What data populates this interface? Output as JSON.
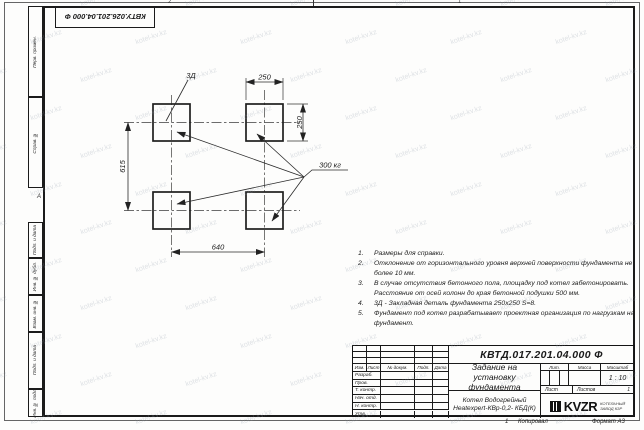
{
  "sheet": {
    "stamp_top": "КВТУ.026.201.04.000 Ф",
    "zone_top_left": "2",
    "zone_top_right": "1",
    "zone_bottom": "1",
    "zone_letter": "А",
    "copied_label": "Копировал",
    "format_label": "Формат А3"
  },
  "watermark": {
    "text": "kotel-kv.kz"
  },
  "margin_labels": [
    "Перв. примен.",
    "Справ. №",
    "Подп. и дата",
    "Инв. № дубл.",
    "Взам. инв. №",
    "Подп. и дата",
    "Инв. № подл."
  ],
  "drawing": {
    "dims": {
      "width_top": "250",
      "height_right": "250",
      "height_left": "615",
      "width_bottom": "640"
    },
    "labels": {
      "detail": "3Д",
      "load": "300 кг"
    }
  },
  "notes": [
    {
      "n": "1.",
      "t": "Размеры для справки."
    },
    {
      "n": "2.",
      "t": "Отклонение от горизонтального уровня верхней поверхности фундамента не более 10 мм."
    },
    {
      "n": "3.",
      "t": "В случае отсутствия бетонного пола, площадку под котел забетонировать. Расстояние от осей колонн до края бетонной подушки 500 мм."
    },
    {
      "n": "4.",
      "t": "3Д - Закладная деталь фундамента 250х250 S=8."
    },
    {
      "n": "5.",
      "t": "Фундамент под котел разрабатывает проектная организация по нагрузкам на фундамент."
    }
  ],
  "titleblock": {
    "doc_number": "КВТД.017.201.04.000 Ф",
    "title": "Задание на установку фундамента",
    "product_line1": "Котел Водогрейный",
    "product_line2": "Heatexpert-КВр-0,2- КБД(К)",
    "header_cols": [
      "Изм.",
      "Лист",
      "№ докум.",
      "Подп.",
      "Дата"
    ],
    "sign_rows": [
      "Разраб.",
      "Пров.",
      "Т. контр.",
      "Нач. отд.",
      "Н. контр.",
      "Утв."
    ],
    "lit_label": "Лит.",
    "mass_label": "Масса",
    "scale_label": "Масштаб",
    "scale_value": "1 : 10",
    "sheet_label": "Лист",
    "sheets_label": "Листов",
    "sheets_value": "1",
    "logo_text": "KVZR",
    "logo_caption_line1": "КОТЕЛЬНЫЙ",
    "logo_caption_line2": "ЗАВОД КЗР"
  }
}
